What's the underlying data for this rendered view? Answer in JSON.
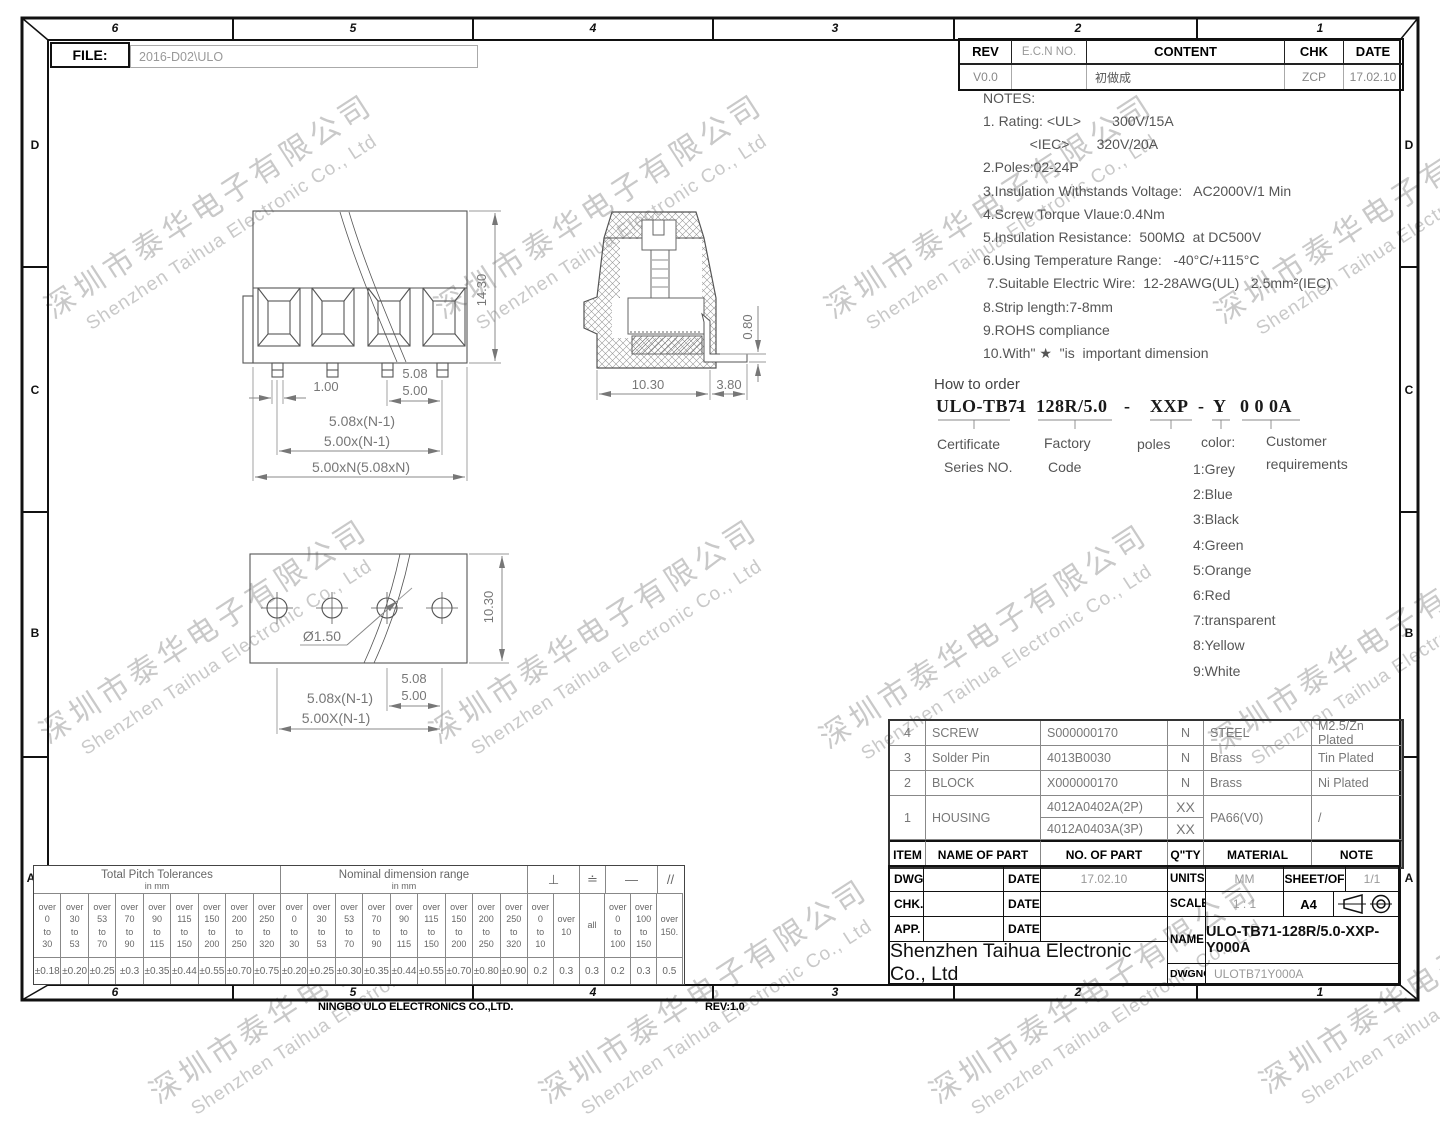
{
  "frame": {
    "file_label": "FILE:",
    "file_value": "2016-D02\\ULO",
    "top_zones": [
      "6",
      "5",
      "4",
      "3",
      "2",
      "1"
    ],
    "side_zones": [
      "D",
      "C",
      "B",
      "A"
    ],
    "footer_company": "NINGBO ULO ELECTRONICS CO.,LTD.",
    "footer_rev": "REV:1.0"
  },
  "rev_table": {
    "headers": [
      "REV",
      "E.C.N  NO.",
      "CONTENT",
      "CHK",
      "DATE"
    ],
    "row": {
      "rev": "V0.0",
      "ecn": "",
      "content": "初做成",
      "chk": "ZCP",
      "date": "17.02.10"
    }
  },
  "notes": {
    "title": "NOTES:",
    "lines": [
      "1. Rating: <UL>        300V/15A",
      "            <IEC>       320V/20A",
      "2.Poles:02-24P",
      "3.Insulation Withstands Voltage:   AC2000V/1 Min",
      "4.Screw Torque Vlaue:0.4Nm",
      "5.Insulation Resistance:  500MΩ  at DC500V",
      "6.Using Temperature Range:   -40°C/+115°C",
      " 7.Suitable Electric Wire:  12-28AWG(UL)   2.5mm²(IEC)",
      "8.Strip length:7-8mm",
      "9.ROHS compliance",
      "10.With\" ★  \"is  important dimension"
    ]
  },
  "order": {
    "title": "How to order",
    "code_parts": [
      "ULO-TB71",
      "-",
      "128R/5.0",
      "-",
      "XXP",
      "-",
      "Y",
      "0 0 0A"
    ],
    "labels": {
      "certificate_1": "Certificate",
      "certificate_2": "Series NO.",
      "factory_1": "Factory",
      "factory_2": "Code",
      "poles": "poles",
      "color": "color:",
      "customer_1": "Customer",
      "customer_2": "requirements"
    },
    "color_options": [
      "1:Grey",
      "2:Blue",
      "3:Black",
      "4:Green",
      "5:Orange",
      "6:Red",
      "7:transparent",
      "8:Yellow",
      "9:White"
    ]
  },
  "parts_table": {
    "headers": [
      "ITEM",
      "NAME OF PART",
      "NO. OF PART",
      "Q\"TY",
      "MATERIAL",
      "NOTE"
    ],
    "rows": [
      {
        "item": "4",
        "name": "SCREW",
        "no": "S000000170",
        "qty": "N",
        "material": "STEEL",
        "note": "M2.5/Zn Plated"
      },
      {
        "item": "3",
        "name": "Solder Pin",
        "no": "4013B0030",
        "qty": "N",
        "material": "Brass",
        "note": "Tin Plated"
      },
      {
        "item": "2",
        "name": "BLOCK",
        "no": "X000000170",
        "qty": "N",
        "material": "Brass",
        "note": "Ni Plated"
      }
    ],
    "housing": {
      "item": "1",
      "name": "HOUSING",
      "no_a": "4012A0402A(2P)",
      "qty_a": "XX",
      "no_b": "4012A0403A(3P)",
      "qty_b": "XX",
      "material": "PA66(V0)",
      "note": "/"
    }
  },
  "title_block": {
    "dwg_label": "DWG.",
    "chk_label": "CHK.",
    "app_label": "APP.",
    "date_label": "DATE",
    "dwg_date": "17.02.10",
    "company": "Shenzhen Taihua Electronic Co., Ltd",
    "units_label": "UNITS",
    "units": "MM",
    "sheet_label": "SHEET/OF",
    "sheet": "1/1",
    "scale_label": "SCALE",
    "scale": "1 : 1",
    "size": "A4",
    "name_label": "NAME",
    "name": "ULO-TB71-128R/5.0-XXP-Y000A",
    "dwgno_label": "DWGNO.",
    "dwgno": "ULOTB71Y000A"
  },
  "tolerance": {
    "pitch_title": "Total Pitch Tolerances",
    "pitch_unit": "in mm",
    "nominal_title": "Nominal dimension range",
    "nominal_unit": "in mm",
    "sym_perp": "⊥",
    "sym_copl": "≐",
    "sym_flat": "—",
    "sym_par": "//",
    "pitch_cols": [
      {
        "l1": "over",
        "l2": "0",
        "l3": "to",
        "l4": "30",
        "v": "±0.18"
      },
      {
        "l1": "over",
        "l2": "30",
        "l3": "to",
        "l4": "53",
        "v": "±0.20"
      },
      {
        "l1": "over",
        "l2": "53",
        "l3": "to",
        "l4": "70",
        "v": "±0.25"
      },
      {
        "l1": "over",
        "l2": "70",
        "l3": "to",
        "l4": "90",
        "v": "±0.3"
      },
      {
        "l1": "over",
        "l2": "90",
        "l3": "to",
        "l4": "115",
        "v": "±0.35"
      },
      {
        "l1": "over",
        "l2": "115",
        "l3": "to",
        "l4": "150",
        "v": "±0.44"
      },
      {
        "l1": "over",
        "l2": "150",
        "l3": "to",
        "l4": "200",
        "v": "±0.55"
      },
      {
        "l1": "over",
        "l2": "200",
        "l3": "to",
        "l4": "250",
        "v": "±0.70"
      },
      {
        "l1": "over",
        "l2": "250",
        "l3": "to",
        "l4": "320",
        "v": "±0.75"
      }
    ],
    "nominal_cols": [
      {
        "l1": "over",
        "l2": "0",
        "l3": "to",
        "l4": "30",
        "v": "±0.20"
      },
      {
        "l1": "over",
        "l2": "30",
        "l3": "to",
        "l4": "53",
        "v": "±0.25"
      },
      {
        "l1": "over",
        "l2": "53",
        "l3": "to",
        "l4": "70",
        "v": "±0.30"
      },
      {
        "l1": "over",
        "l2": "70",
        "l3": "to",
        "l4": "90",
        "v": "±0.35"
      },
      {
        "l1": "over",
        "l2": "90",
        "l3": "to",
        "l4": "115",
        "v": "±0.44"
      },
      {
        "l1": "over",
        "l2": "115",
        "l3": "to",
        "l4": "150",
        "v": "±0.55"
      },
      {
        "l1": "over",
        "l2": "150",
        "l3": "to",
        "l4": "200",
        "v": "±0.70"
      },
      {
        "l1": "over",
        "l2": "200",
        "l3": "to",
        "l4": "250",
        "v": "±0.80"
      },
      {
        "l1": "over",
        "l2": "250",
        "l3": "to",
        "l4": "320",
        "v": "±0.90"
      }
    ],
    "geo_cols": [
      {
        "l1": "over",
        "l2": "0",
        "l3": "to",
        "l4": "10",
        "v": "0.2"
      },
      {
        "l1": "over",
        "l2": "10",
        "l3": "",
        "l4": "",
        "v": "0.3"
      },
      {
        "l1": "all",
        "l2": "",
        "l3": "",
        "l4": "",
        "v": "0.3"
      },
      {
        "l1": "over",
        "l2": "0",
        "l3": "to",
        "l4": "100",
        "v": "0.2"
      },
      {
        "l1": "over",
        "l2": "100",
        "l3": "to",
        "l4": "150",
        "v": "0.3"
      },
      {
        "l1": "over",
        "l2": "150.",
        "l3": "",
        "l4": "",
        "v": "0.5"
      }
    ]
  },
  "dims": {
    "front": {
      "height": "14.30",
      "pin": "1.00",
      "p1": "5.08",
      "p2": "5.00",
      "s1": "5.08x(N-1)",
      "s2": "5.00x(N-1)",
      "total": "5.00xN(5.08xN)"
    },
    "side": {
      "w": "10.30",
      "tail": "3.80",
      "pin_t": "0.80"
    },
    "bottom": {
      "hole": "Ø1.50",
      "h": "10.30",
      "p1": "5.08",
      "p2": "5.00",
      "s1": "5.08x(N-1)",
      "s2": "5.00X(N-1)"
    }
  },
  "watermark": {
    "cn": "深圳市泰华电子有限公司",
    "en": "Shenzhen Taihua Electronic Co., Ltd"
  }
}
